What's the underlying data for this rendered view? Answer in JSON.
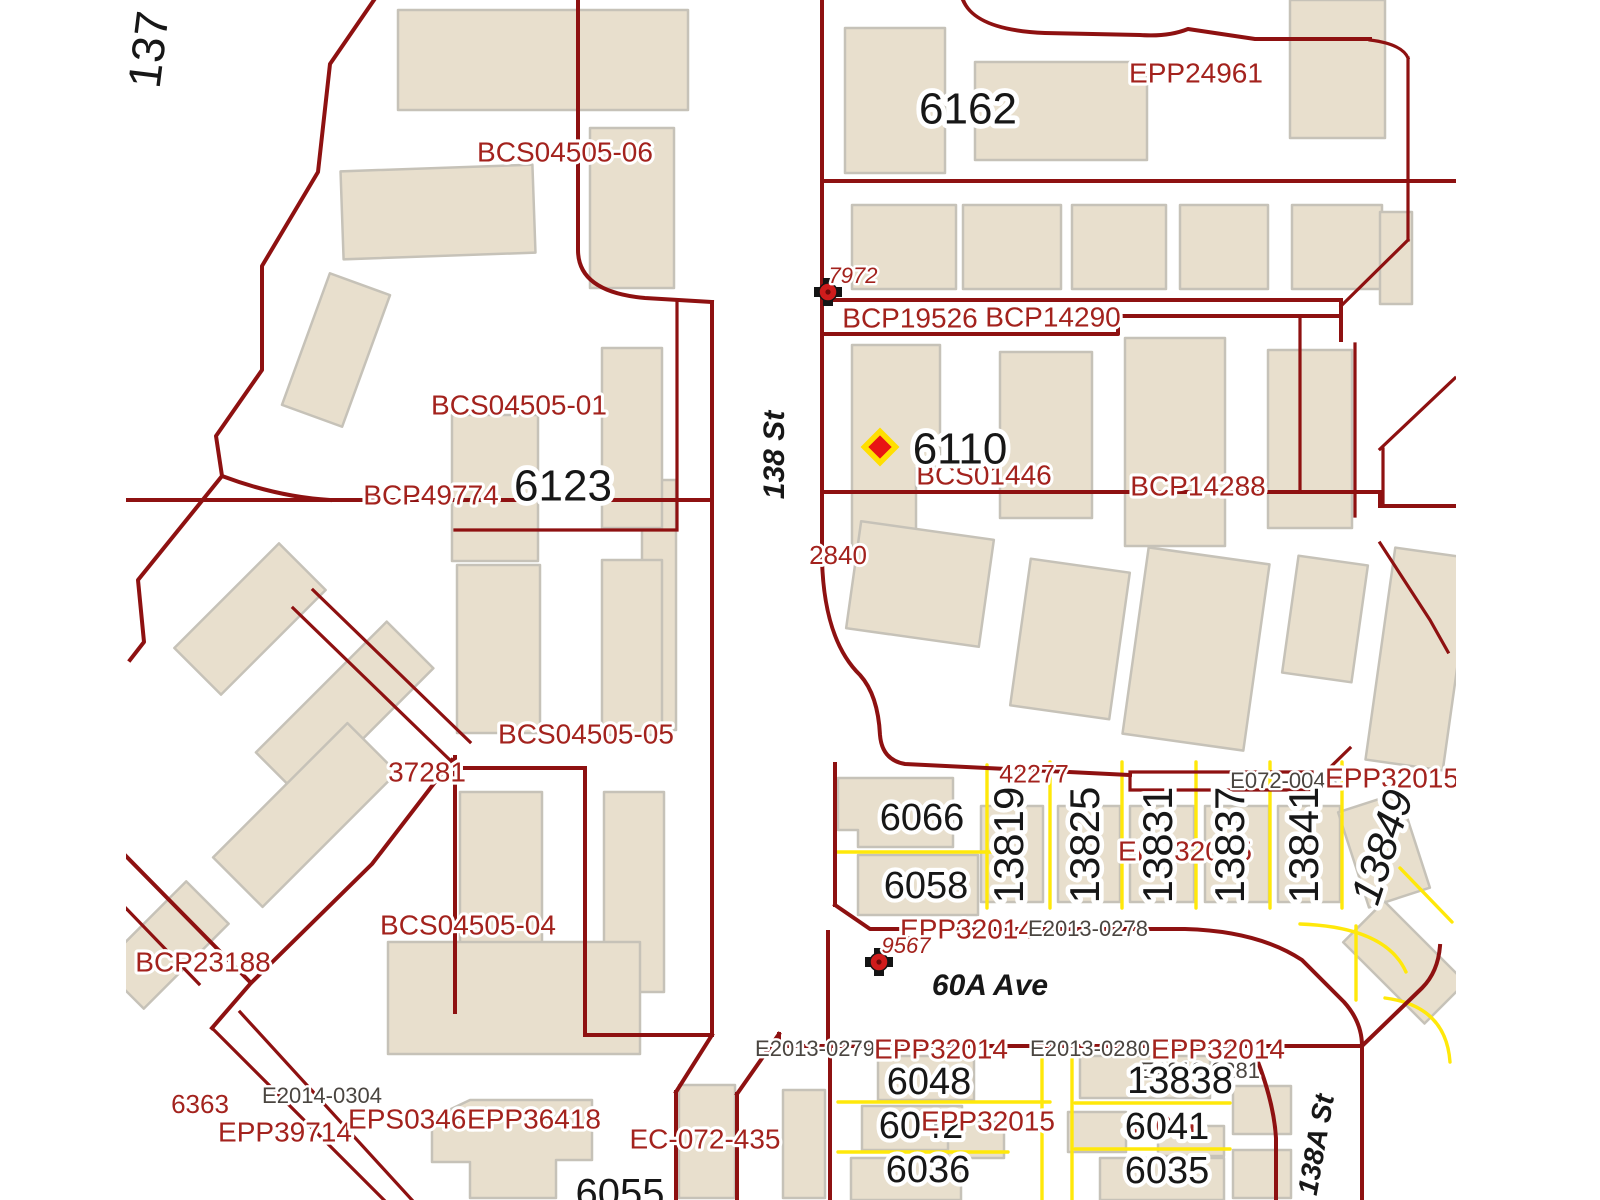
{
  "map": {
    "type": "cadastral-parcel-map",
    "colors": {
      "background": "#ffffff",
      "parcel_line": "#8e1111",
      "lot_line_yellow": "#ffe80a",
      "building_fill": "#e8dfcd",
      "building_stroke": "#c6c2b8",
      "plan_label": "#a3221d",
      "address_label": "#171717",
      "reference_label": "#4a4540",
      "marker_red": "#d01c1c",
      "diamond_fill": "#e81414",
      "diamond_outline": "#ffdf00"
    },
    "streets": [
      {
        "name": "138 St"
      },
      {
        "name": "60A Ave"
      },
      {
        "name": "138A St"
      },
      {
        "name": "137"
      }
    ],
    "control_monuments": [
      {
        "id": "7972",
        "x": 828,
        "y": 292
      },
      {
        "id": "9567",
        "x": 879,
        "y": 962
      }
    ],
    "poi_diamond": {
      "x": 880,
      "y": 447
    },
    "labels": [
      {
        "text": "137",
        "x": 152,
        "y": 50,
        "size": 46,
        "color": "addr",
        "rotate": -83
      },
      {
        "text": "BCS04505-06",
        "x": 565,
        "y": 154,
        "size": 28,
        "color": "plan"
      },
      {
        "text": "EPP24961",
        "x": 1196,
        "y": 75,
        "size": 28,
        "color": "plan"
      },
      {
        "text": "6162",
        "x": 968,
        "y": 112,
        "size": 44,
        "color": "addr"
      },
      {
        "text": "7972",
        "x": 853,
        "y": 277,
        "size": 22,
        "color": "plan",
        "italic": true
      },
      {
        "text": "BCP19526",
        "x": 910,
        "y": 320,
        "size": 28,
        "color": "plan"
      },
      {
        "text": "BCP14290",
        "x": 1053,
        "y": 319,
        "size": 28,
        "color": "plan"
      },
      {
        "text": "BCS04505-01",
        "x": 519,
        "y": 407,
        "size": 28,
        "color": "plan"
      },
      {
        "text": "BCP49774",
        "x": 431,
        "y": 497,
        "size": 28,
        "color": "plan"
      },
      {
        "text": "6123",
        "x": 563,
        "y": 489,
        "size": 44,
        "color": "addr"
      },
      {
        "text": "138 St",
        "x": 776,
        "y": 455,
        "size": 30,
        "color": "addr",
        "bold": true,
        "italic": true,
        "rotate": -90
      },
      {
        "text": "BCS01446",
        "x": 984,
        "y": 477,
        "size": 28,
        "color": "plan"
      },
      {
        "text": "6110",
        "x": 960,
        "y": 452,
        "size": 44,
        "color": "addr"
      },
      {
        "text": "BCP14288",
        "x": 1198,
        "y": 488,
        "size": 28,
        "color": "plan"
      },
      {
        "text": "2840",
        "x": 838,
        "y": 557,
        "size": 26,
        "color": "plan"
      },
      {
        "text": "BCS04505-05",
        "x": 586,
        "y": 736,
        "size": 28,
        "color": "plan"
      },
      {
        "text": "37281",
        "x": 427,
        "y": 774,
        "size": 28,
        "color": "plan"
      },
      {
        "text": "BCS04505-04",
        "x": 468,
        "y": 927,
        "size": 28,
        "color": "plan"
      },
      {
        "text": "BCP23188",
        "x": 203,
        "y": 964,
        "size": 28,
        "color": "plan"
      },
      {
        "text": "42277",
        "x": 1034,
        "y": 776,
        "size": 25,
        "color": "plan"
      },
      {
        "text": "E072-0048",
        "x": 1284,
        "y": 782,
        "size": 22,
        "color": "ref"
      },
      {
        "text": "EPP32015",
        "x": 1392,
        "y": 780,
        "size": 28,
        "color": "plan"
      },
      {
        "text": "EPP32015",
        "x": 1185,
        "y": 853,
        "size": 28,
        "color": "plan"
      },
      {
        "text": "13819",
        "x": 1012,
        "y": 845,
        "size": 42,
        "color": "addr",
        "rotate": -90
      },
      {
        "text": "13825",
        "x": 1088,
        "y": 845,
        "size": 42,
        "color": "addr",
        "rotate": -90
      },
      {
        "text": "13831",
        "x": 1161,
        "y": 845,
        "size": 42,
        "color": "addr",
        "rotate": -90
      },
      {
        "text": "13837",
        "x": 1233,
        "y": 845,
        "size": 42,
        "color": "addr",
        "rotate": -90
      },
      {
        "text": "13841",
        "x": 1307,
        "y": 845,
        "size": 42,
        "color": "addr",
        "rotate": -90
      },
      {
        "text": "13849",
        "x": 1385,
        "y": 848,
        "size": 42,
        "color": "addr",
        "rotate": -72,
        "italic": true
      },
      {
        "text": "6066",
        "x": 922,
        "y": 820,
        "size": 38,
        "color": "addr"
      },
      {
        "text": "6058",
        "x": 926,
        "y": 888,
        "size": 38,
        "color": "addr"
      },
      {
        "text": "EPP32014",
        "x": 967,
        "y": 931,
        "size": 28,
        "color": "plan"
      },
      {
        "text": "E2013-0278",
        "x": 1088,
        "y": 930,
        "size": 22,
        "color": "ref"
      },
      {
        "text": "9567",
        "x": 906,
        "y": 947,
        "size": 22,
        "color": "plan",
        "italic": true
      },
      {
        "text": "60A Ave",
        "x": 990,
        "y": 987,
        "size": 30,
        "color": "addr",
        "bold": true,
        "italic": true
      },
      {
        "text": "E2013-0279",
        "x": 815,
        "y": 1050,
        "size": 22,
        "color": "ref"
      },
      {
        "text": "EPP32014",
        "x": 941,
        "y": 1051,
        "size": 28,
        "color": "plan"
      },
      {
        "text": "E2013-0280",
        "x": 1090,
        "y": 1050,
        "size": 22,
        "color": "ref"
      },
      {
        "text": "EPP32014",
        "x": 1218,
        "y": 1051,
        "size": 28,
        "color": "plan"
      },
      {
        "text": "E2013-0281",
        "x": 1200,
        "y": 1072,
        "size": 22,
        "color": "ref"
      },
      {
        "text": "6048",
        "x": 929,
        "y": 1084,
        "size": 38,
        "color": "addr"
      },
      {
        "text": "13838",
        "x": 1180,
        "y": 1083,
        "size": 38,
        "color": "addr"
      },
      {
        "text": "6042",
        "x": 921,
        "y": 1128,
        "size": 38,
        "color": "addr"
      },
      {
        "text": "EPP32015",
        "x": 988,
        "y": 1123,
        "size": 28,
        "color": "plan"
      },
      {
        "text": "36016",
        "x": 1164,
        "y": 1128,
        "size": 30,
        "color": "plan"
      },
      {
        "text": "6041",
        "x": 1167,
        "y": 1129,
        "size": 38,
        "color": "addr"
      },
      {
        "text": "6036",
        "x": 928,
        "y": 1172,
        "size": 38,
        "color": "addr"
      },
      {
        "text": "6035",
        "x": 1167,
        "y": 1173,
        "size": 38,
        "color": "addr"
      },
      {
        "text": "138A St",
        "x": 1318,
        "y": 1145,
        "size": 28,
        "color": "addr",
        "bold": true,
        "italic": true,
        "rotate": -80
      },
      {
        "text": "6363",
        "x": 200,
        "y": 1106,
        "size": 26,
        "color": "plan"
      },
      {
        "text": "E2014-0304",
        "x": 322,
        "y": 1097,
        "size": 22,
        "color": "ref"
      },
      {
        "text": "EPP39714",
        "x": 285,
        "y": 1134,
        "size": 28,
        "color": "plan"
      },
      {
        "text": "EPS03467",
        "x": 415,
        "y": 1121,
        "size": 28,
        "color": "plan"
      },
      {
        "text": "EPP36418",
        "x": 534,
        "y": 1121,
        "size": 28,
        "color": "plan"
      },
      {
        "text": "EC-072-435",
        "x": 705,
        "y": 1141,
        "size": 28,
        "color": "plan"
      },
      {
        "text": "6055",
        "x": 620,
        "y": 1196,
        "size": 40,
        "color": "addr"
      }
    ]
  }
}
